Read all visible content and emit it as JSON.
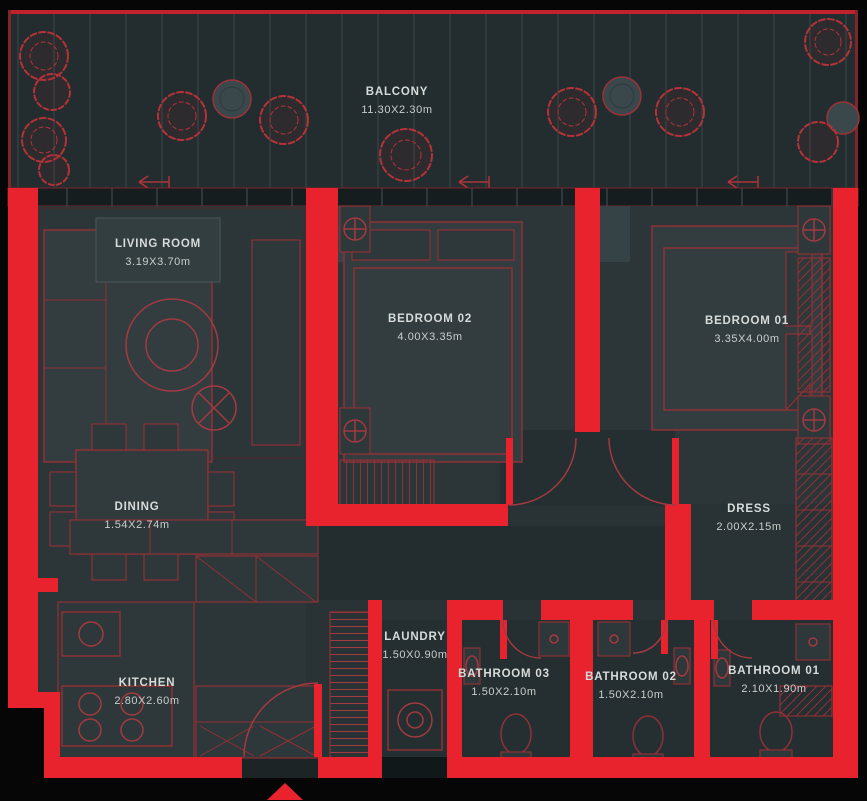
{
  "plan": {
    "type": "apartment-floor-plan",
    "rooms": [
      {
        "id": "balcony",
        "name": "BALCONY",
        "dims": "11.30X2.30m",
        "x": 397,
        "y": 86
      },
      {
        "id": "living-room",
        "name": "LIVING ROOM",
        "dims": "3.19X3.70m",
        "x": 158,
        "y": 238
      },
      {
        "id": "bedroom-02",
        "name": "BEDROOM 02",
        "dims": "4.00X3.35m",
        "x": 430,
        "y": 313
      },
      {
        "id": "bedroom-01",
        "name": "BEDROOM 01",
        "dims": "3.35X4.00m",
        "x": 747,
        "y": 315
      },
      {
        "id": "dining",
        "name": "DINING",
        "dims": "1.54X2.74m",
        "x": 137,
        "y": 501
      },
      {
        "id": "dress",
        "name": "DRESS",
        "dims": "2.00X2.15m",
        "x": 749,
        "y": 503
      },
      {
        "id": "laundry",
        "name": "LAUNDRY",
        "dims": "1.50X0.90m",
        "x": 415,
        "y": 631
      },
      {
        "id": "bathroom-03",
        "name": "BATHROOM 03",
        "dims": "1.50X2.10m",
        "x": 504,
        "y": 668
      },
      {
        "id": "bathroom-02",
        "name": "BATHROOM 02",
        "dims": "1.50X2.10m",
        "x": 631,
        "y": 671
      },
      {
        "id": "bathroom-01",
        "name": "BATHROOM 01",
        "dims": "2.10X1.90m",
        "x": 774,
        "y": 665
      },
      {
        "id": "kitchen",
        "name": "KITCHEN",
        "dims": "2.80X2.60m",
        "x": 147,
        "y": 677
      }
    ],
    "icons": {
      "entrance_marker": "entrance-arrow-icon",
      "trees": "tree-icon",
      "planters": "planter-icon",
      "sliding_door_arrows": "slide-arrow-icon",
      "lamps": "lamp-icon",
      "toilets": "toilet-icon",
      "washer": "washer-icon",
      "stove": "stove-icon"
    }
  },
  "colors": {
    "background": "#060607",
    "wall_red": "#e8232e",
    "furniture_red": "#8f3136",
    "door_arc_red": "#a23a40",
    "floor": "#2c3638",
    "balcony_floor": "#232c2e",
    "text": "#d7dbda"
  }
}
